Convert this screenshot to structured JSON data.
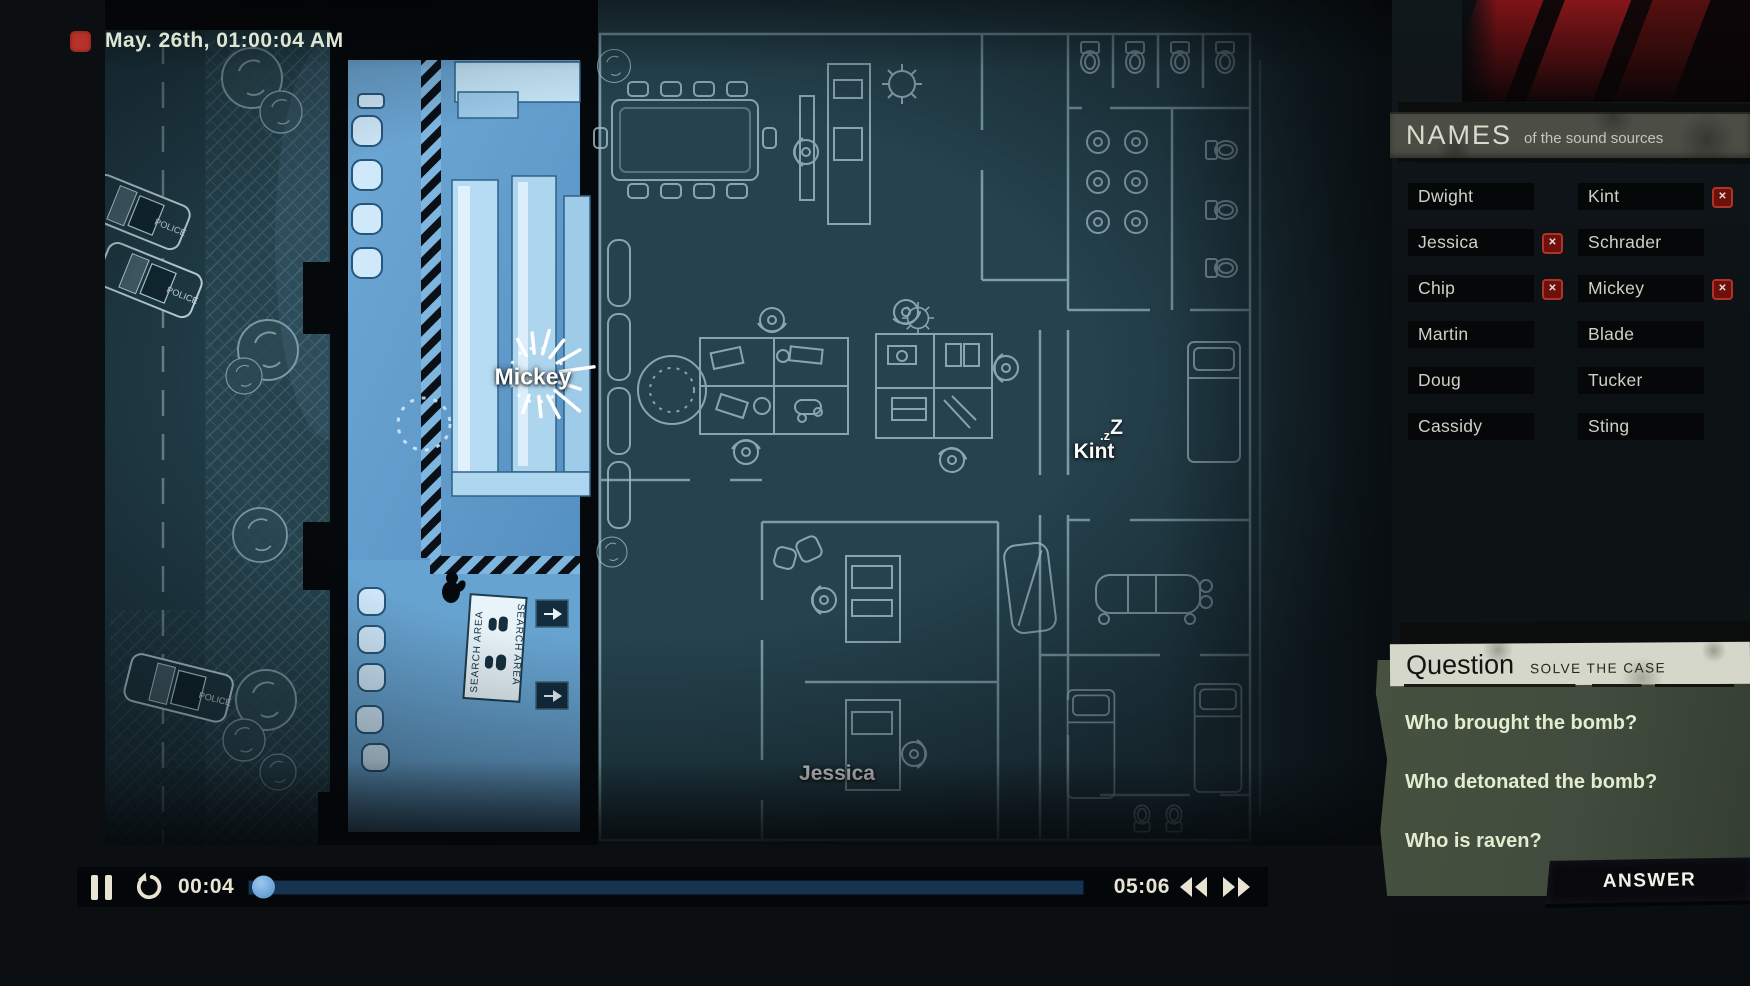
{
  "window": {
    "timestamp": "May. 26th, 01:00:04 AM"
  },
  "names_panel": {
    "title": "NAMES",
    "subtitle": "of the sound sources",
    "items": [
      {
        "label": "Dwight",
        "muted": false
      },
      {
        "label": "Kint",
        "muted": true
      },
      {
        "label": "Jessica",
        "muted": true
      },
      {
        "label": "Schrader",
        "muted": false
      },
      {
        "label": "Chip",
        "muted": true
      },
      {
        "label": "Mickey",
        "muted": true
      },
      {
        "label": "Martin",
        "muted": false
      },
      {
        "label": "Blade",
        "muted": false
      },
      {
        "label": "Doug",
        "muted": false
      },
      {
        "label": "Tucker",
        "muted": false
      },
      {
        "label": "Cassidy",
        "muted": false
      },
      {
        "label": "Sting",
        "muted": false
      }
    ],
    "mute_glyph": "✕"
  },
  "question_panel": {
    "title": "Question",
    "subtitle": "SOLVE THE CASE",
    "questions": [
      "Who brought the bomb?",
      "Who detonated the bomb?",
      "Who is raven?"
    ],
    "answer_button": "ANSWER"
  },
  "playback": {
    "current_time": "00:04",
    "total_time": "05:06",
    "progress_percent": 1.3
  },
  "map": {
    "characters": [
      {
        "name": "Mickey",
        "status": "speaking"
      },
      {
        "name": "Kint",
        "status": "sleeping",
        "sleep_small": ".z",
        "sleep_big": "Z"
      },
      {
        "name": "Jessica",
        "status": "idle"
      }
    ],
    "search_area_label": "SEARCH AREA",
    "police_label": "POLICE"
  },
  "colors": {
    "accent_red": "#b5332b",
    "lit_room_blue": "#619fce",
    "blueprint_line": "#9cc0cd",
    "knob_blue": "#6ea6da",
    "panel_sage": "#414c3e"
  }
}
